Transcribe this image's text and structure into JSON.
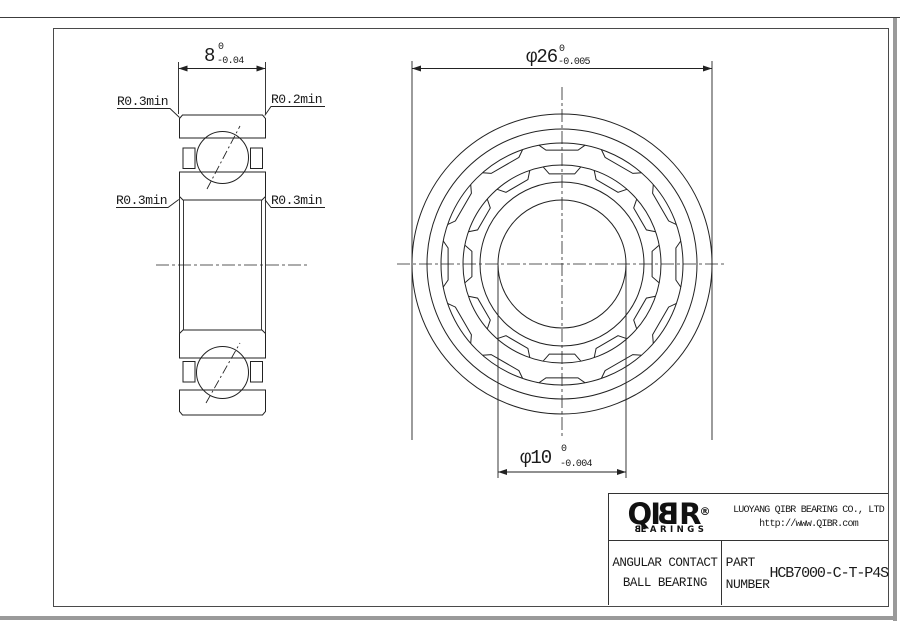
{
  "dims": {
    "width": {
      "value": "8",
      "tol_top": "0",
      "tol_bottom": "-0.04"
    },
    "od": {
      "value": "φ26",
      "tol_top": "0",
      "tol_bottom": "-0.005"
    },
    "bore": {
      "value": "φ10",
      "tol_top": "0",
      "tol_bottom": "-0.004"
    }
  },
  "callouts": {
    "top_left": "R0.3min",
    "top_right": "R0.2min",
    "mid_left": "R0.3min",
    "mid_right": "R0.3min"
  },
  "front_view": {
    "cx": 562,
    "cy": 264,
    "ring_radii": [
      150,
      135,
      121,
      99,
      82,
      64
    ],
    "pocket_count": 12,
    "half_ring": 11,
    "half_chord": 8,
    "outer_band": {
      "r_ring": 121,
      "r_chord": 115
    },
    "inner_band": {
      "r_ring": 99,
      "r_chord": 91
    }
  },
  "title_block": {
    "logo_prefix": "QI",
    "logo_b": "B",
    "logo_suffix": "R",
    "registered": "®",
    "brand_sub_b": "B",
    "brand_sub_rest": "EARINGS",
    "company": "LUOYANG QIBR BEARING CO., LTD",
    "url": "http://www.QIBR.com",
    "product_line1": "ANGULAR CONTACT",
    "product_line2": "BALL BEARING",
    "part_label_line1": "PART",
    "part_label_line2": "NUMBER",
    "part_number": "HCB7000-C-T-P4S"
  }
}
